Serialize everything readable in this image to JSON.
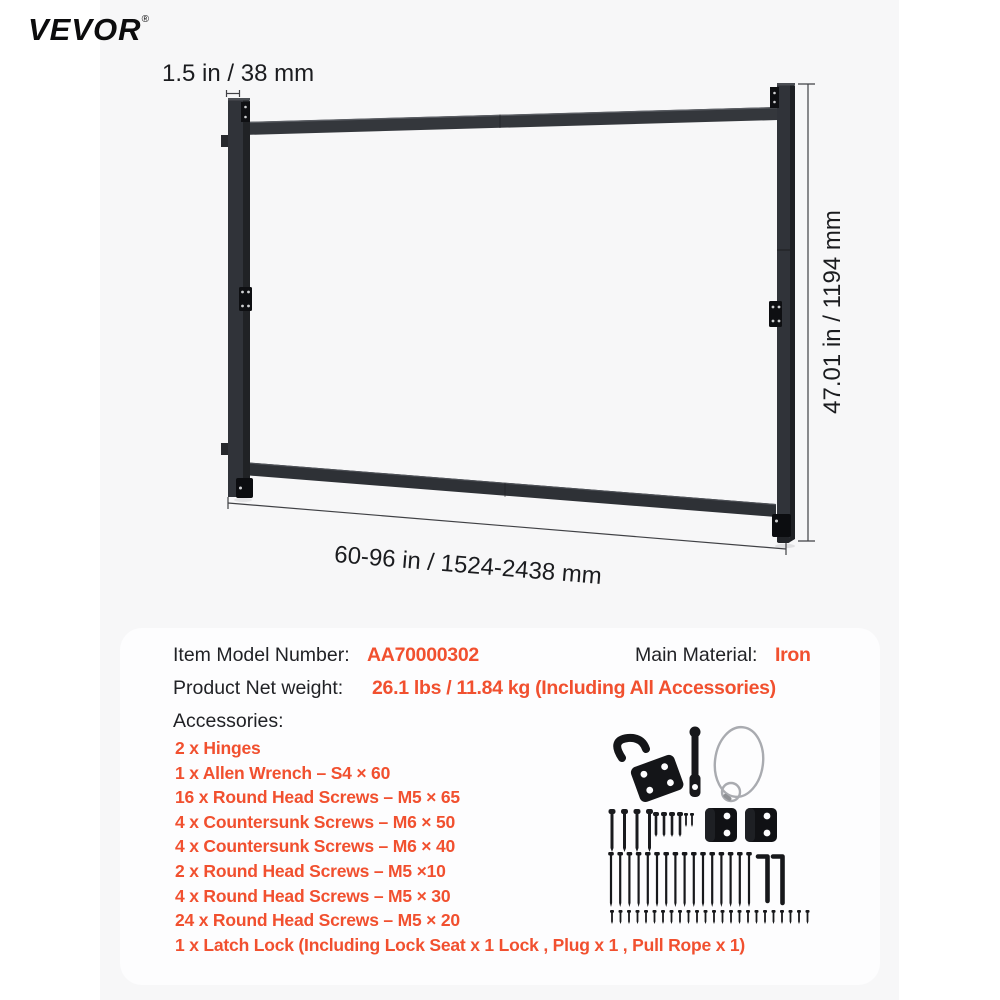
{
  "page": {
    "brand": "VEVOR",
    "registered": "®",
    "background_color": "#f7f7f8",
    "frame_color": "#303339",
    "accent_color": "#f1502f"
  },
  "diagram": {
    "width_label": "1.5 in / 38 mm",
    "height_label": "47.01 in / 1194 mm",
    "range_label": "60-96 in / 1524-2438 mm"
  },
  "specs": {
    "model_label": "Item Model Number:",
    "model_value": "AA70000302",
    "material_label": "Main Material:",
    "material_value": "Iron",
    "weight_label": "Product Net weight:",
    "weight_value": "26.1 lbs / 11.84 kg (Including All Accessories)",
    "accessories_label": "Accessories:",
    "accessories": [
      "2 x Hinges",
      "1 x Allen Wrench – S4 × 60",
      "16 x Round Head Screws – M5 × 65",
      "4 x Countersunk Screws – M6 × 50",
      "4 x Countersunk Screws – M6 × 40",
      "2 x Round Head Screws – M5 ×10",
      "4 x Round Head Screws – M5 × 30",
      "24 x Round Head Screws – M5 × 20",
      "1 x Latch Lock (Including Lock Seat x 1 Lock , Plug x 1 , Pull Rope x 1)"
    ]
  }
}
